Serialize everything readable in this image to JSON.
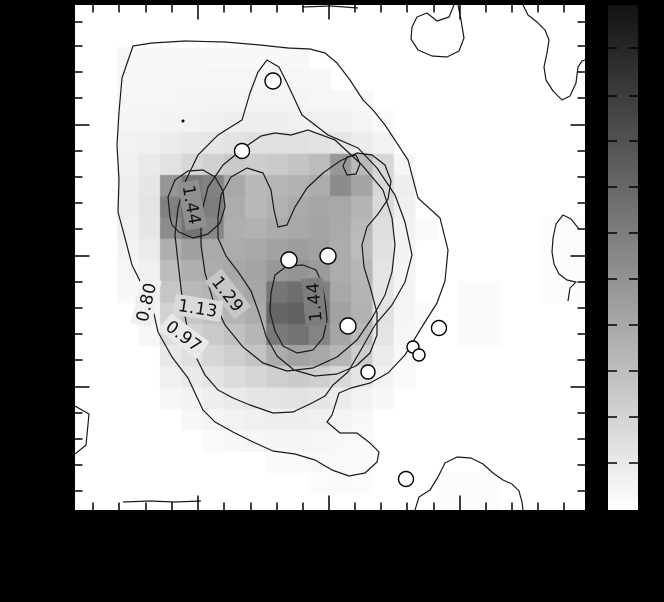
{
  "window": {
    "background": "#000000"
  },
  "plot": {
    "frame_color": "#000000",
    "background": "#ffffff",
    "tick_color": "#000000",
    "x_ticks_minor": [
      18,
      44,
      71,
      97,
      149,
      176,
      202,
      228,
      280,
      306,
      332,
      359,
      411,
      437,
      463,
      489
    ],
    "x_ticks_major": [
      123,
      254,
      385
    ],
    "y_ticks_minor": [
      17,
      41,
      67,
      93,
      146,
      172,
      198,
      224,
      277,
      303,
      329,
      355,
      408,
      434,
      460,
      486
    ],
    "y_ticks_major": [
      120,
      251,
      382
    ]
  },
  "colorbar": {
    "top_color": "#121212",
    "bottom_color": "#ffffff",
    "tick_ys": [
      43,
      91,
      136,
      182,
      228,
      274,
      320,
      366,
      412,
      458
    ]
  },
  "chart_data": {
    "type": "heatmap",
    "title": "",
    "description": "Grayscale intensity map with overlaid contour lines, contour level labels, white circular source markers and a vertical grayscale colorbar (dark top, white bottom). No numeric axis labels are visible (black margins).",
    "contour_levels": [
      0.8,
      0.97,
      1.13,
      1.29,
      1.44
    ],
    "grid_cell_px": 21.25,
    "grid": [
      [
        255,
        255,
        255,
        255,
        255,
        255,
        255,
        255,
        255,
        255,
        255,
        255,
        255,
        255,
        255,
        255,
        255,
        255,
        255,
        255,
        255,
        255,
        255,
        255
      ],
      [
        255,
        255,
        255,
        255,
        255,
        255,
        255,
        255,
        255,
        255,
        255,
        255,
        255,
        255,
        255,
        255,
        255,
        255,
        255,
        255,
        255,
        255,
        255,
        255
      ],
      [
        255,
        255,
        248,
        248,
        248,
        248,
        248,
        248,
        248,
        248,
        248,
        255,
        255,
        255,
        255,
        255,
        255,
        255,
        255,
        255,
        255,
        255,
        255,
        255
      ],
      [
        255,
        255,
        247,
        247,
        247,
        247,
        246,
        246,
        246,
        246,
        246,
        247,
        255,
        255,
        255,
        255,
        255,
        255,
        255,
        255,
        255,
        255,
        255,
        255
      ],
      [
        255,
        255,
        246,
        246,
        246,
        245,
        244,
        244,
        244,
        244,
        244,
        246,
        246,
        248,
        255,
        255,
        255,
        255,
        255,
        255,
        255,
        255,
        255,
        255
      ],
      [
        255,
        255,
        245,
        244,
        243,
        242,
        240,
        238,
        238,
        238,
        240,
        240,
        240,
        244,
        250,
        255,
        255,
        255,
        255,
        255,
        255,
        255,
        255,
        255
      ],
      [
        255,
        255,
        242,
        240,
        236,
        232,
        230,
        226,
        224,
        224,
        224,
        226,
        230,
        236,
        242,
        255,
        255,
        255,
        255,
        255,
        255,
        255,
        255,
        255
      ],
      [
        255,
        255,
        240,
        234,
        226,
        215,
        208,
        202,
        205,
        202,
        196,
        188,
        152,
        186,
        215,
        246,
        255,
        255,
        255,
        255,
        255,
        255,
        255,
        255
      ],
      [
        255,
        255,
        238,
        230,
        150,
        122,
        130,
        168,
        185,
        182,
        178,
        172,
        140,
        165,
        215,
        238,
        255,
        255,
        255,
        255,
        255,
        255,
        255,
        255
      ],
      [
        255,
        255,
        238,
        228,
        128,
        108,
        125,
        172,
        185,
        178,
        170,
        166,
        168,
        180,
        218,
        240,
        255,
        255,
        255,
        255,
        255,
        255,
        255,
        255
      ],
      [
        255,
        255,
        240,
        230,
        140,
        115,
        135,
        175,
        178,
        172,
        168,
        164,
        170,
        185,
        222,
        242,
        250,
        255,
        255,
        255,
        255,
        255,
        252,
        252
      ],
      [
        255,
        255,
        242,
        235,
        175,
        160,
        170,
        172,
        168,
        162,
        158,
        162,
        172,
        188,
        225,
        243,
        255,
        255,
        255,
        255,
        255,
        255,
        252,
        252
      ],
      [
        255,
        255,
        246,
        240,
        188,
        175,
        172,
        168,
        163,
        152,
        148,
        155,
        172,
        182,
        228,
        244,
        255,
        255,
        255,
        255,
        255,
        255,
        252,
        252
      ],
      [
        255,
        255,
        248,
        242,
        198,
        185,
        180,
        173,
        166,
        118,
        110,
        128,
        168,
        180,
        228,
        245,
        255,
        255,
        250,
        250,
        255,
        255,
        252,
        252
      ],
      [
        255,
        255,
        255,
        244,
        210,
        198,
        190,
        180,
        172,
        102,
        96,
        122,
        162,
        178,
        226,
        245,
        250,
        255,
        250,
        250,
        255,
        255,
        255,
        255
      ],
      [
        255,
        255,
        255,
        246,
        220,
        210,
        202,
        193,
        182,
        122,
        114,
        132,
        166,
        186,
        228,
        246,
        255,
        255,
        250,
        250,
        255,
        255,
        255,
        255
      ],
      [
        255,
        255,
        255,
        255,
        232,
        224,
        214,
        206,
        196,
        172,
        162,
        168,
        182,
        206,
        235,
        248,
        255,
        255,
        255,
        255,
        255,
        255,
        255,
        255
      ],
      [
        255,
        255,
        255,
        255,
        240,
        234,
        227,
        220,
        214,
        207,
        202,
        207,
        217,
        230,
        243,
        250,
        255,
        255,
        255,
        255,
        255,
        255,
        255,
        255
      ],
      [
        255,
        255,
        255,
        255,
        246,
        242,
        238,
        234,
        230,
        228,
        226,
        229,
        235,
        242,
        248,
        255,
        255,
        255,
        255,
        255,
        255,
        255,
        255,
        255
      ],
      [
        255,
        255,
        255,
        255,
        255,
        248,
        245,
        242,
        240,
        238,
        238,
        240,
        244,
        248,
        255,
        255,
        255,
        255,
        255,
        255,
        255,
        255,
        255,
        255
      ],
      [
        255,
        255,
        255,
        255,
        255,
        255,
        250,
        248,
        246,
        245,
        245,
        246,
        248,
        250,
        255,
        255,
        255,
        255,
        255,
        255,
        255,
        255,
        255,
        255
      ],
      [
        255,
        255,
        255,
        255,
        255,
        255,
        255,
        255,
        255,
        250,
        249,
        248,
        249,
        250,
        255,
        255,
        255,
        255,
        255,
        255,
        255,
        255,
        255,
        255
      ],
      [
        255,
        255,
        255,
        255,
        255,
        255,
        255,
        255,
        255,
        255,
        255,
        251,
        250,
        251,
        255,
        255,
        255,
        252,
        252,
        252,
        255,
        255,
        255,
        255
      ],
      [
        255,
        255,
        255,
        255,
        255,
        255,
        255,
        255,
        255,
        255,
        255,
        255,
        255,
        255,
        255,
        255,
        255,
        252,
        252,
        252,
        255,
        255,
        255,
        255
      ]
    ],
    "contours": [
      {
        "level": "0.80",
        "d": "M58,41 L77,38 L110,36 L150,37 L185,40 L213,43 L235,44 L250,48 L262,58 L275,75 L288,95 L298,105 L310,120 L333,155 L343,193 L365,213 L373,245 L370,276 L362,298 L345,325 L330,350 L313,368 L295,378 L276,383 L264,388 L257,410 L252,417 L265,428 L282,428 L295,438 L304,447 L302,457 L290,468 L274,471 L257,465 L240,455 L220,449 L198,446 L178,437 L158,427 L140,417 L128,405 L113,373 L97,352 L83,327 L77,300 L67,280 L57,260 L50,233 L43,207 L44,175 L42,140 L44,107 L47,73 Z"
      },
      {
        "level": "0.97",
        "d": "M167,115 L175,88 L183,67 L192,55 L204,62 L212,78 L220,95 L227,110 L253,130 L283,143 L302,163 L320,190 L330,217 L337,250 L330,277 L317,300 L300,320 L287,343 L273,367 L258,380 L250,391 L237,398 L218,407 L198,408 L175,400 L158,393 L143,385 L130,370 L120,350 L113,327 L108,300 L103,257 L100,230 L103,203 L110,177 L123,150 L143,130 Z"
      },
      {
        "level": "1.13",
        "d": "M170,142 L186,131 L200,128 L216,130 L233,125 L260,135 L287,160 L308,185 L317,213 L320,240 L317,267 L310,290 L297,313 L282,335 L262,352 L238,363 L212,366 L188,358 L168,342 L150,320 L138,295 L130,268 L126,240 L126,210 L133,182 L148,160 Z"
      },
      {
        "level": "1.29",
        "d": "M143,212 L146,190 L156,172 L172,163 L188,168 L196,185 L199,205 L203,222 L212,220 L220,202 L232,183 L248,168 L265,156 L282,148 L297,150 L310,160 L316,176 L313,194 L303,209 L292,222 L287,240 L289,262 L296,285 L302,308 L302,330 L295,348 L281,361 L262,369 L240,371 L219,365 L202,351 L191,331 L184,308 L176,286 L164,268 L151,251 L143,233 Z"
      },
      {
        "level": "1.44",
        "d": "M95,212 L93,192 L100,175 L113,166 L128,165 L140,172 L148,186 L150,202 L145,218 L133,229 L118,233 L104,227 L97,220 Z"
      },
      {
        "level": "1.44",
        "d": "M196,288 L200,270 L212,261 L228,260 L241,265 L247,278 L250,296 L252,315 L248,333 L238,345 L222,348 L208,341 L200,326 L195,307 Z"
      },
      {
        "level": "1.44",
        "d": "M272,152 L281,150 L285,159 L281,169 L272,170 L268,161 Z"
      },
      {
        "level": "0.80",
        "d": "M379,0 L374,12 L362,16 L352,8 L342,12 L337,22 L336,34 L343,45 L357,51 L372,52 L384,46 L389,33 L386,15 L383,0"
      },
      {
        "level": "0.80",
        "d": "M448,0 L453,10 L462,17 L470,25 L474,35 L472,48 L469,62 L471,75 L478,86 L487,95 L495,91 L501,78 L503,62 L507,56 L510,55"
      },
      {
        "level": "0.80",
        "d": "M504,224 L496,214 L488,210 L481,219 L478,233 L477,247 L479,259 L484,269 L492,275 L501,277 L495,283 L493,296"
      },
      {
        "level": "0.80",
        "d": "M340,505 L344,492 L355,485 L363,472 L370,458 L382,452 L396,453 L408,459 L418,468 L428,475 L437,479 L444,486 L447,497 L448,505"
      },
      {
        "level": "0.80",
        "d": "M0,401 L14,409 L11,440 L0,449"
      },
      {
        "level": "0.80",
        "d": "M228,2 L256,1 L283,3"
      },
      {
        "level": "0.80",
        "d": "M48,497 L75,496 L100,497 L126,496"
      }
    ],
    "contour_labels": [
      {
        "text": "1.44",
        "x": 117,
        "y": 200,
        "rotate": 80,
        "bg": "#8f8f8f"
      },
      {
        "text": "1.44",
        "x": 239,
        "y": 297,
        "rotate": -95,
        "bg": "#7d7d7d"
      },
      {
        "text": "1.29",
        "x": 153,
        "y": 289,
        "rotate": 52,
        "bg": "#c6c6c6"
      },
      {
        "text": "1.13",
        "x": 123,
        "y": 303,
        "rotate": 9,
        "bg": "#dadada"
      },
      {
        "text": "0.97",
        "x": 109,
        "y": 331,
        "rotate": 37,
        "bg": "#e9e9e9"
      },
      {
        "text": "0.80",
        "x": 71,
        "y": 297,
        "rotate": -77,
        "bg": "#f0f0f0"
      }
    ],
    "markers": [
      {
        "x": 198,
        "y": 76,
        "r": 8
      },
      {
        "x": 167,
        "y": 146,
        "r": 7.5
      },
      {
        "x": 214,
        "y": 255,
        "r": 8
      },
      {
        "x": 253,
        "y": 251,
        "r": 8
      },
      {
        "x": 273,
        "y": 321,
        "r": 8
      },
      {
        "x": 364,
        "y": 323,
        "r": 7.5
      },
      {
        "x": 338,
        "y": 342,
        "r": 6
      },
      {
        "x": 344,
        "y": 350,
        "r": 6
      },
      {
        "x": 293,
        "y": 367,
        "r": 7
      },
      {
        "x": 331,
        "y": 474,
        "r": 7.5
      }
    ],
    "point_dot": {
      "x": 108,
      "y": 116,
      "r": 1.5
    }
  }
}
